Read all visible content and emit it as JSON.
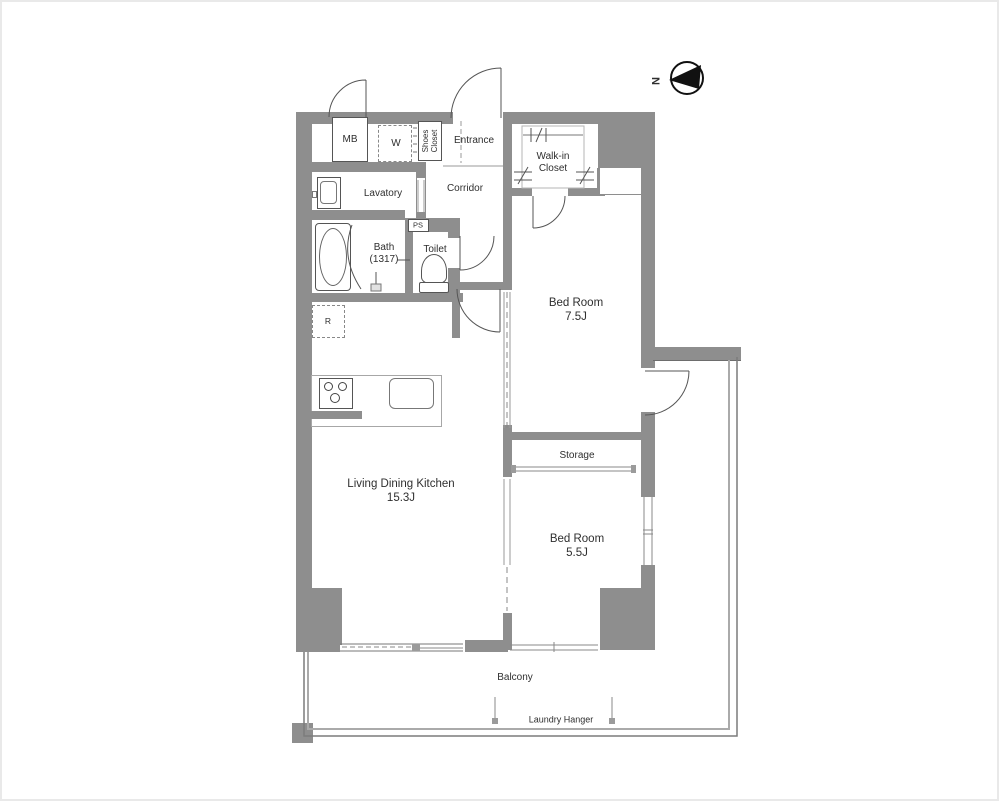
{
  "compass": {
    "north_label": "N"
  },
  "rooms": {
    "mb": {
      "label": "MB"
    },
    "washer": {
      "label": "W"
    },
    "shoes_closet": {
      "label": "Shoes Closet"
    },
    "entrance": {
      "label": "Entrance"
    },
    "walk_in_closet": {
      "label": "Walk-in Closet"
    },
    "lavatory": {
      "label": "Lavatory"
    },
    "corridor": {
      "label": "Corridor"
    },
    "pipe_space": {
      "label": "PS"
    },
    "bath": {
      "label": "Bath",
      "size": "(1317)"
    },
    "toilet": {
      "label": "Toilet"
    },
    "bedroom_1": {
      "label": "Bed Room",
      "size": "7.5J"
    },
    "storage": {
      "label": "Storage"
    },
    "bedroom_2": {
      "label": "Bed Room",
      "size": "5.5J"
    },
    "ldk": {
      "label": "Living Dining Kitchen",
      "size": "15.3J"
    },
    "refrigerator": {
      "label": "R"
    }
  },
  "outdoor": {
    "balcony": {
      "label": "Balcony"
    },
    "laundry_hanger": {
      "label": "Laundry Hanger"
    }
  },
  "colors": {
    "wall": "#8e8e8e",
    "line": "#555555",
    "light_line": "#9e9e9e",
    "text": "#2f2f2f"
  }
}
